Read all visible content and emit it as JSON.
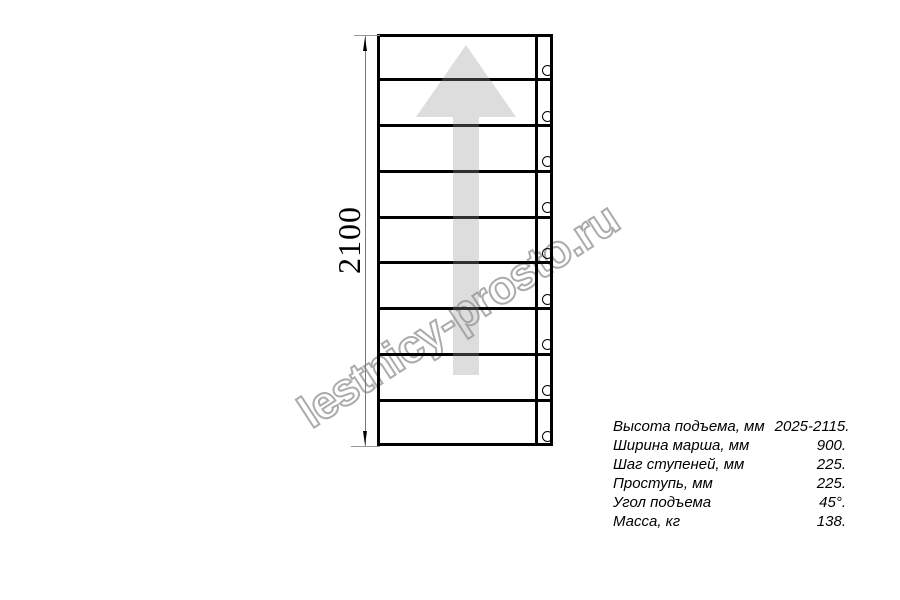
{
  "page": {
    "background_color": "#ffffff"
  },
  "watermark": {
    "text": "lestnicy-prosto.ru",
    "stroke_color": "#ababab"
  },
  "diagram": {
    "type": "staircase-plan-top-view",
    "steps_count": 9,
    "bolts_count": 9,
    "line_color": "#000000",
    "arrow_direction": "up",
    "arrow_color": "rgba(150,150,150,0.32)"
  },
  "dimension": {
    "label": "2100",
    "text_color": "#000000",
    "line_color": "#777777"
  },
  "specs": {
    "rows": [
      {
        "label": "Высота подъема, мм",
        "value": "2025-2115."
      },
      {
        "label": "Ширина марша, мм",
        "value": "900."
      },
      {
        "label": "Шаг ступеней, мм",
        "value": "225."
      },
      {
        "label": "Проступь, мм",
        "value": "225."
      },
      {
        "label": "Угол подъема",
        "value": "45°."
      },
      {
        "label": "Масса, кг",
        "value": "138."
      }
    ]
  }
}
